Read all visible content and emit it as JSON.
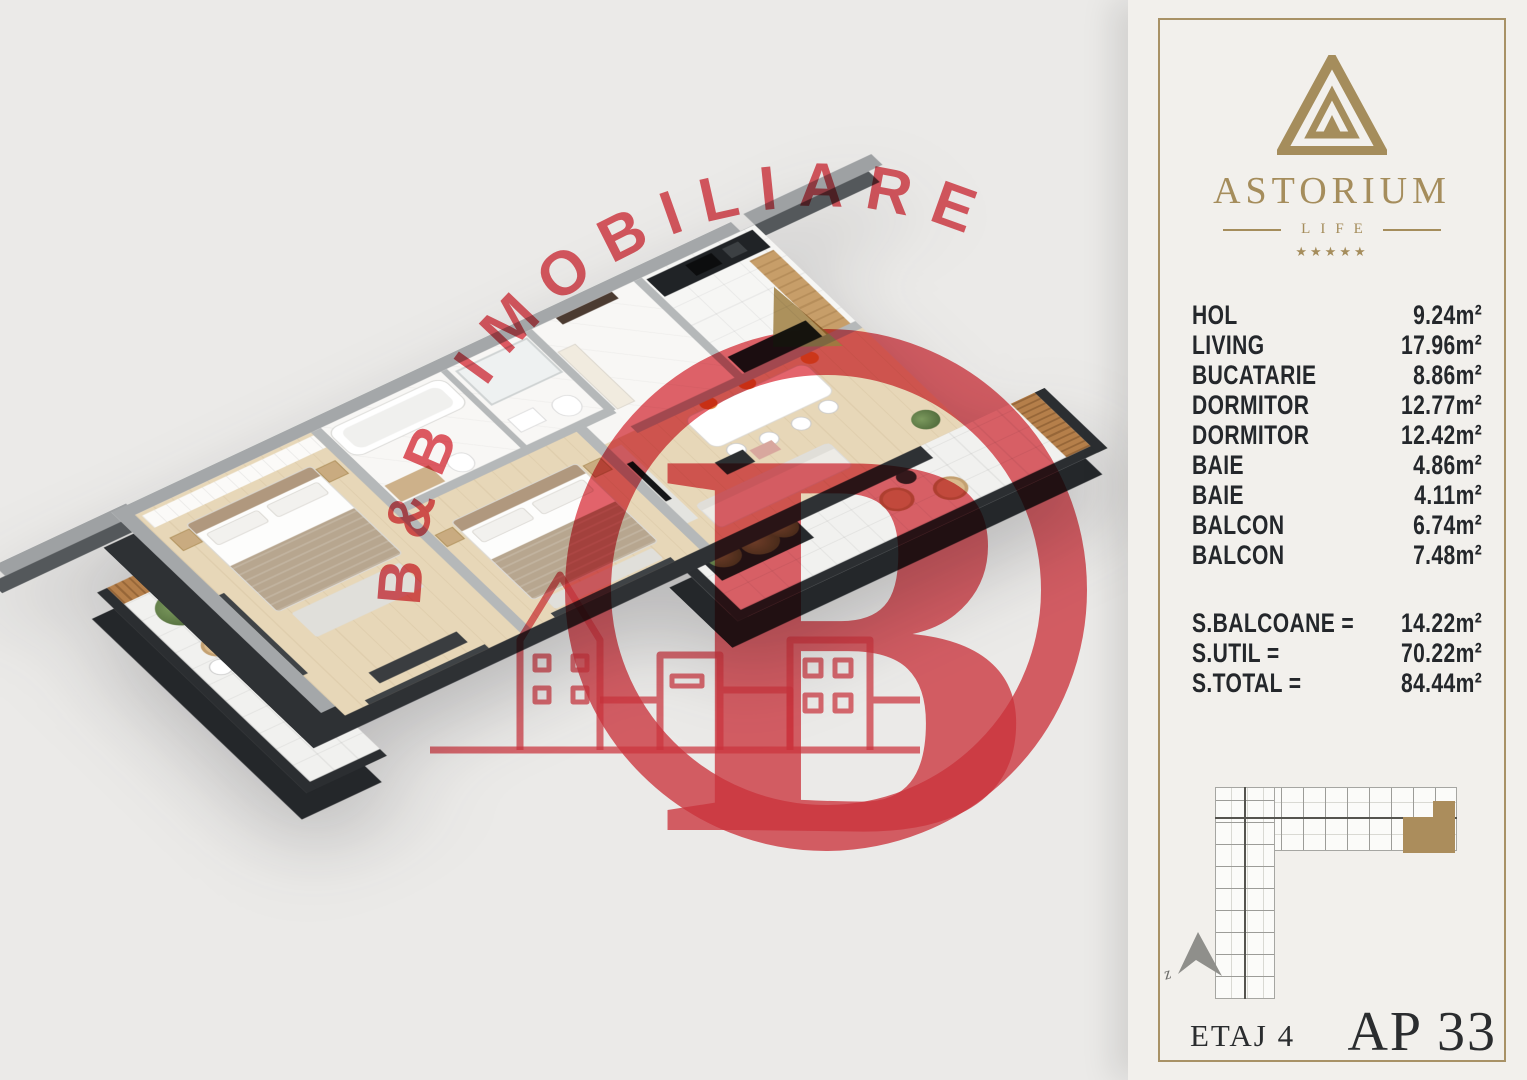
{
  "watermark": {
    "brand_text": "B&B IMOBILIARE",
    "monogram": "B",
    "red": "#dd3843",
    "gold": "#ae9057"
  },
  "sidebar": {
    "logo": {
      "name": "ASTORIUM",
      "subtitle": "LIFE",
      "stars": "★★★★★",
      "gold": "#a58d5c"
    },
    "rooms": [
      {
        "label": "HOL",
        "area": "9.24m²"
      },
      {
        "label": "LIVING",
        "area": "17.96m²"
      },
      {
        "label": "BUCATARIE",
        "area": "8.86m²"
      },
      {
        "label": "DORMITOR",
        "area": "12.77m²"
      },
      {
        "label": "DORMITOR",
        "area": "12.42m²"
      },
      {
        "label": "BAIE",
        "area": "4.86m²"
      },
      {
        "label": "BAIE",
        "area": "4.11m²"
      },
      {
        "label": "BALCON",
        "area": "6.74m²"
      },
      {
        "label": "BALCON",
        "area": "7.48m²"
      }
    ],
    "totals": [
      {
        "label": "S.BALCOANE =",
        "value": "14.22m²"
      },
      {
        "label": "S.UTIL =",
        "value": "70.22m²"
      },
      {
        "label": "S.TOTAL =",
        "value": "84.44m²"
      }
    ],
    "site_plan": {
      "block_label": "B",
      "north_label": "z",
      "highlight": "#ab8d5c"
    },
    "floor_label": "ETAJ 4",
    "apartment_label": "AP 33"
  },
  "floor_plan": {
    "colors": {
      "wall_top": "#a4a7a9",
      "wall_dark": "#2e3134",
      "wood_floor": "#e7d7b8",
      "wood_accent": "#b57f4a",
      "tile": "#f1f1ef",
      "chair_accent": "#e0772f",
      "greenery": "#55703f"
    }
  }
}
